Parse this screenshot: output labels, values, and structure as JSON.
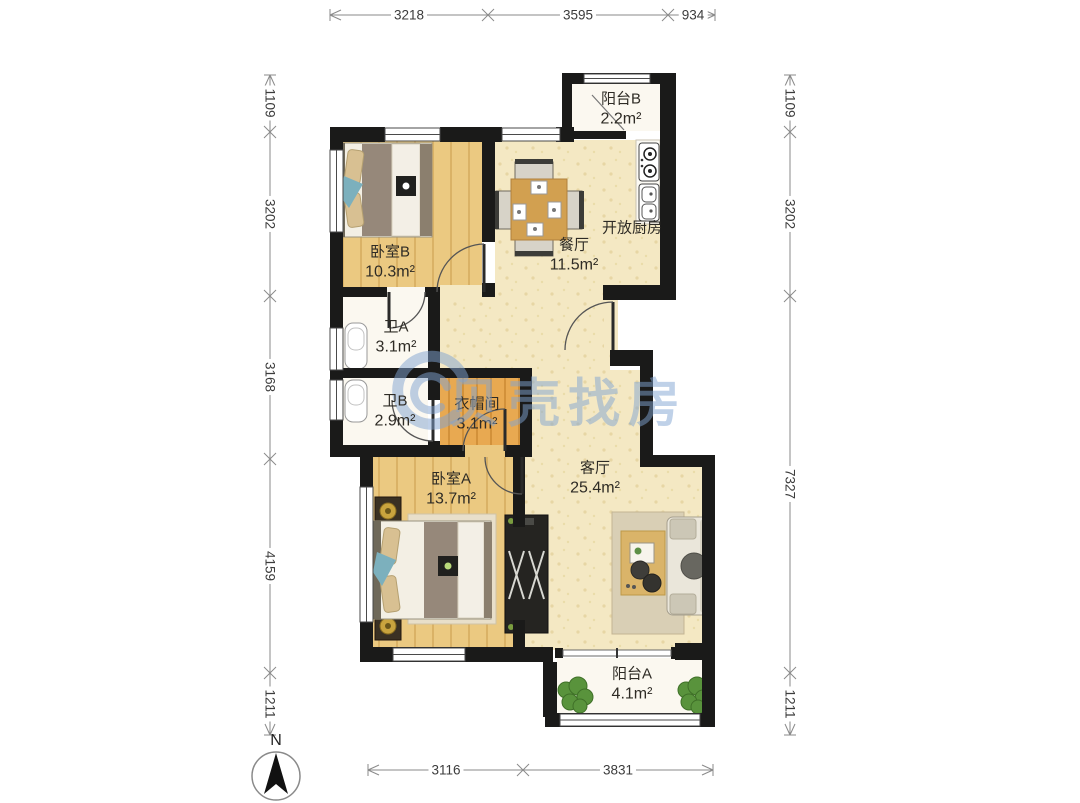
{
  "rooms": {
    "balcony_b": {
      "name": "阳台B",
      "area": "2.2m²"
    },
    "bedroom_b": {
      "name": "卧室B",
      "area": "10.3m²"
    },
    "dining": {
      "name": "餐厅",
      "area": "11.5m²"
    },
    "kitchen": {
      "name": "开放厨房"
    },
    "bath_a": {
      "name": "卫A",
      "area": "3.1m²"
    },
    "bath_b": {
      "name": "卫B",
      "area": "2.9m²"
    },
    "closet": {
      "name": "衣帽间",
      "area": "3.1m²"
    },
    "bedroom_a": {
      "name": "卧室A",
      "area": "13.7m²"
    },
    "living": {
      "name": "客厅",
      "area": "25.4m²"
    },
    "balcony_a": {
      "name": "阳台A",
      "area": "4.1m²"
    }
  },
  "dimensions": {
    "top": [
      "3218",
      "3595",
      "934"
    ],
    "bottom": [
      "3116",
      "3831"
    ],
    "left": [
      "1109",
      "3202",
      "3168",
      "4159",
      "1211"
    ],
    "right": [
      "1109",
      "3202",
      "7327",
      "1211"
    ]
  },
  "compass": {
    "label": "N"
  },
  "watermark": {
    "text": "贝壳找房"
  },
  "colors": {
    "wall": "#1a1a19",
    "wood_floor": "#ebc981",
    "cream_floor": "#f4e8c3",
    "closet_floor": "#e8a951",
    "white_floor": "#fbf8f0",
    "watermark_blue": "#80a3d2",
    "dimension_gray": "#8a8a8a"
  }
}
